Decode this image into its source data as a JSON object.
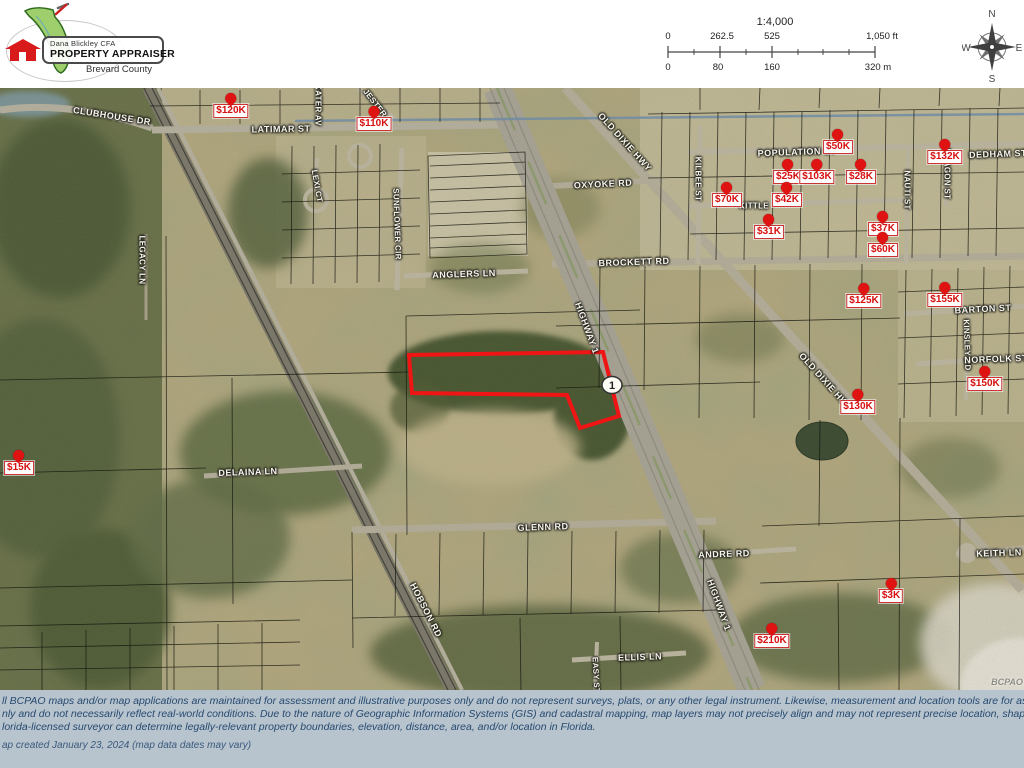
{
  "header": {
    "logo": {
      "appraiser_name": "Dana Blickley CFA",
      "title": "PROPERTY APPRAISER",
      "county": "Brevard County"
    },
    "scalebar": {
      "ratio": "1:4,000",
      "feet": [
        "0",
        "262.5",
        "525",
        "1,050 ft"
      ],
      "meters": [
        "0",
        "80",
        "160",
        "320 m"
      ]
    },
    "compass": {
      "n": "N",
      "e": "E",
      "s": "S",
      "w": "W"
    }
  },
  "map": {
    "route_shield": "1",
    "watermark": "BCPAO",
    "parcel_outline_color": "#f01515",
    "marker_color": "#e01313",
    "streets": [
      {
        "text": "CLUBHOUSE DR"
      },
      {
        "text": "LATIMAR ST"
      },
      {
        "text": "KATER AV"
      },
      {
        "text": "JESTER"
      },
      {
        "text": "OLD DIXIE HWY"
      },
      {
        "text": "OXYOKE RD"
      },
      {
        "text": "KILBEE ST"
      },
      {
        "text": "POPULATION ST"
      },
      {
        "text": "DEDHAM ST"
      },
      {
        "text": "KITTLE"
      },
      {
        "text": "NAUTI ST"
      },
      {
        "text": "DRAGON ST"
      },
      {
        "text": "BROCKETT RD"
      },
      {
        "text": "LEXI CT"
      },
      {
        "text": "SUNFLOWER CIR"
      },
      {
        "text": "ANGLERS LN"
      },
      {
        "text": "LEGACY LN"
      },
      {
        "text": "BARTON ST"
      },
      {
        "text": "KINSLEY RD"
      },
      {
        "text": "NORFOLK ST"
      },
      {
        "text": "OLD DIXIE HWY"
      },
      {
        "text": "HIGHWAY 1"
      },
      {
        "text": "HIGHWAY 1"
      },
      {
        "text": "DELAINA LN"
      },
      {
        "text": "GLENN RD"
      },
      {
        "text": "ANDRE RD"
      },
      {
        "text": "KEITH LN"
      },
      {
        "text": "HOBSON RD"
      },
      {
        "text": "ELLIS LN"
      },
      {
        "text": "EASY ST"
      }
    ],
    "markers": [
      {
        "price": "$120K"
      },
      {
        "price": "$110K"
      },
      {
        "price": "$50K"
      },
      {
        "price": "$25K"
      },
      {
        "price": "$103K"
      },
      {
        "price": "$28K"
      },
      {
        "price": "$70K"
      },
      {
        "price": "$42K"
      },
      {
        "price": "$132K"
      },
      {
        "price": "$31K"
      },
      {
        "price": "$37K"
      },
      {
        "price": "$60K"
      },
      {
        "price": "$125K"
      },
      {
        "price": "$155K"
      },
      {
        "price": "$150K"
      },
      {
        "price": "$130K"
      },
      {
        "price": "$15K"
      },
      {
        "price": "$3K"
      },
      {
        "price": "$210K"
      }
    ]
  },
  "footer": {
    "line1": "ll BCPAO maps and/or map applications are maintained for assessment and illustrative purposes only and do not represent surveys, plats, or any other legal instrument. Likewise, measurement and location tools are for assessment and illustrative purpose",
    "line2": "nly and do not necessarily reflect real-world conditions. Due to the nature of Geographic Information Systems (GIS) and cadastral mapping, map layers may not precisely align and may not represent precise location, shape, and/or legal boundaries. Only a",
    "line3": "lorida-licensed surveyor can determine legally-relevant property boundaries, elevation, distance, area, and/or location in Florida.",
    "created": "ap created January 23, 2024 (map data dates may vary)"
  }
}
